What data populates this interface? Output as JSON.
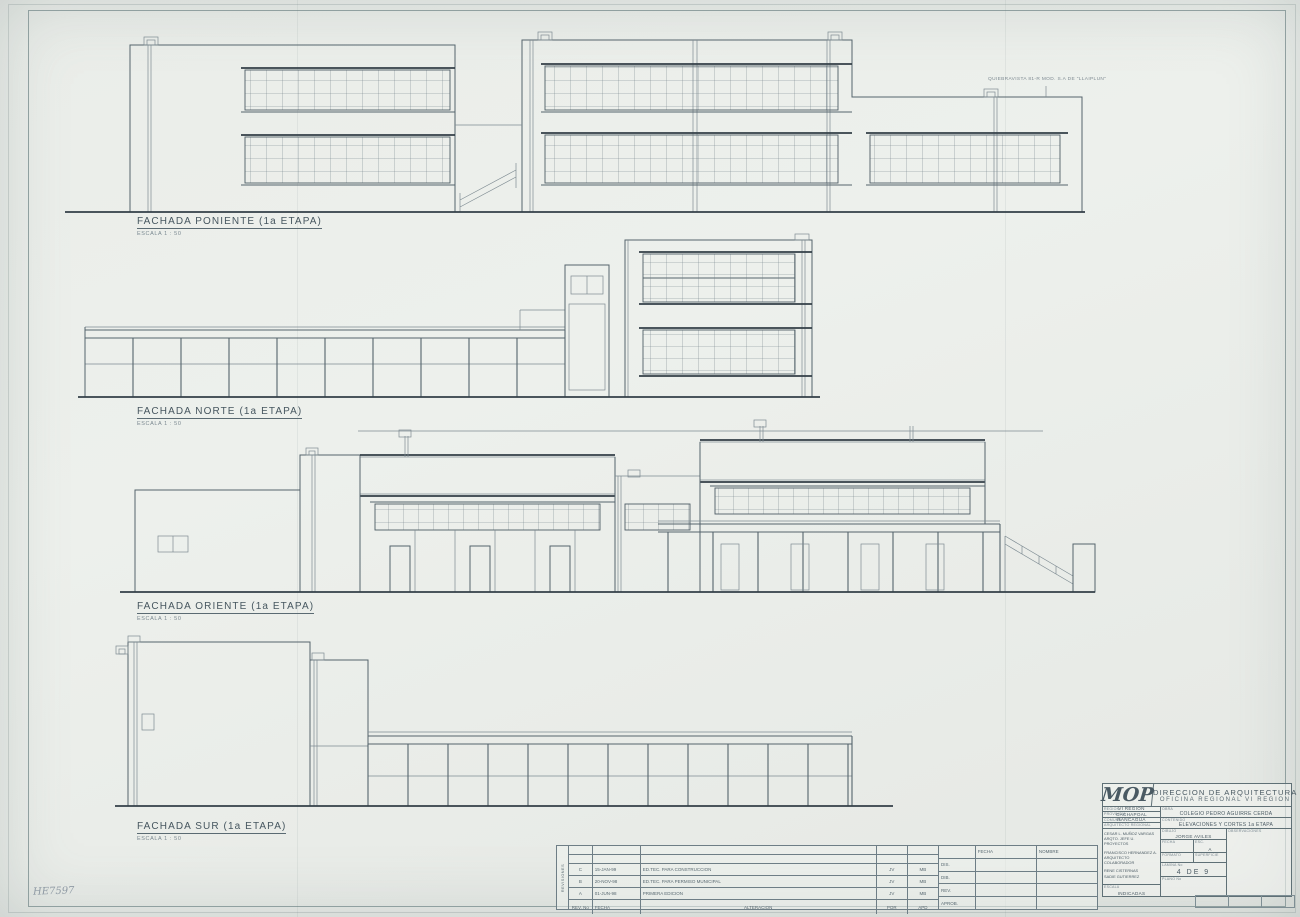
{
  "sheet": {
    "frame_mark": "HE7597",
    "annotation": "QUIEBRAVISTA 81-R MOD. S.A DE \"LLAIPLUN\""
  },
  "facades": [
    {
      "title": "FACHADA PONIENTE (1a ETAPA)",
      "scale": "ESCALA 1 : 50"
    },
    {
      "title": "FACHADA NORTE (1a ETAPA)",
      "scale": "ESCALA 1 : 50"
    },
    {
      "title": "FACHADA ORIENTE (1a ETAPA)",
      "scale": "ESCALA 1 : 50"
    },
    {
      "title": "FACHADA SUR (1a ETAPA)",
      "scale": "ESCALA 1 : 50"
    }
  ],
  "revisions": {
    "side_label": "REVISIONES",
    "rows": [
      {
        "rev": "C",
        "date": "15-JAN-99",
        "desc": "ED.TEC. PARA CONSTRUCCION",
        "by": "JV",
        "chk": "MB"
      },
      {
        "rev": "B",
        "date": "20-NOV-98",
        "desc": "ED.TEC. PARA PERMISO MUNICIPAL",
        "by": "JV",
        "chk": "MB"
      },
      {
        "rev": "A",
        "date": "01-JUN-98",
        "desc": "PRIMERA EDICION",
        "by": "JV",
        "chk": "MB"
      }
    ],
    "footer": {
      "rev_no": "REV. No",
      "fecha": "FECHA",
      "alteracion": "ALTERACION",
      "por": "POR",
      "apd": "APD"
    },
    "sign": {
      "fecha": "FECHA",
      "nombre": "NOMBRE",
      "rows": [
        "DIS.",
        "DIB.",
        "REV.",
        "APROB."
      ]
    }
  },
  "title_block": {
    "logo": "MOP",
    "org1": "DIRECCION DE ARQUITECTURA",
    "org2": "OFICINA REGIONAL VI REGION",
    "region_label": "REGION",
    "region": "VI REGION",
    "provincia_label": "PROVINCIA",
    "provincia": "CACHAPOAL",
    "comuna_label": "COMUNA",
    "comuna": "RANCAGUA",
    "arq_regional_label": "ARQUITECTO REGIONAL",
    "obra_label": "OBRA",
    "obra": "COLEGIO PEDRO AGUIRRE CERDA",
    "contenido_label": "CONTENIDO",
    "contenido": "ELEVACIONES Y CORTES 1a ETAPA",
    "dibujo_label": "DIBUJO",
    "dibujo": "JORGE AVILES",
    "fecha_label": "FECHA",
    "esc_label": "ESC.",
    "esc": "A",
    "formato_label": "FORMATO",
    "superficie_label": "SUPERFICIE",
    "lamina_label": "LAMINA No",
    "lamina": "4 DE 9",
    "plano_label": "PLANO No",
    "obs_label": "OBSERVACIONES",
    "names": [
      "CESAR L. MUÑOZ VARGAS",
      "ARQTO. JEFE U. PROYECTOS",
      "FRANCISCO HERNANDEZ A.",
      "ARQUITECTO COLABORADOR",
      "RENE CISTERNAS",
      "SADIE GUTIERREZ"
    ],
    "escala_label": "ESCALA",
    "escala": "INDICADAS"
  }
}
